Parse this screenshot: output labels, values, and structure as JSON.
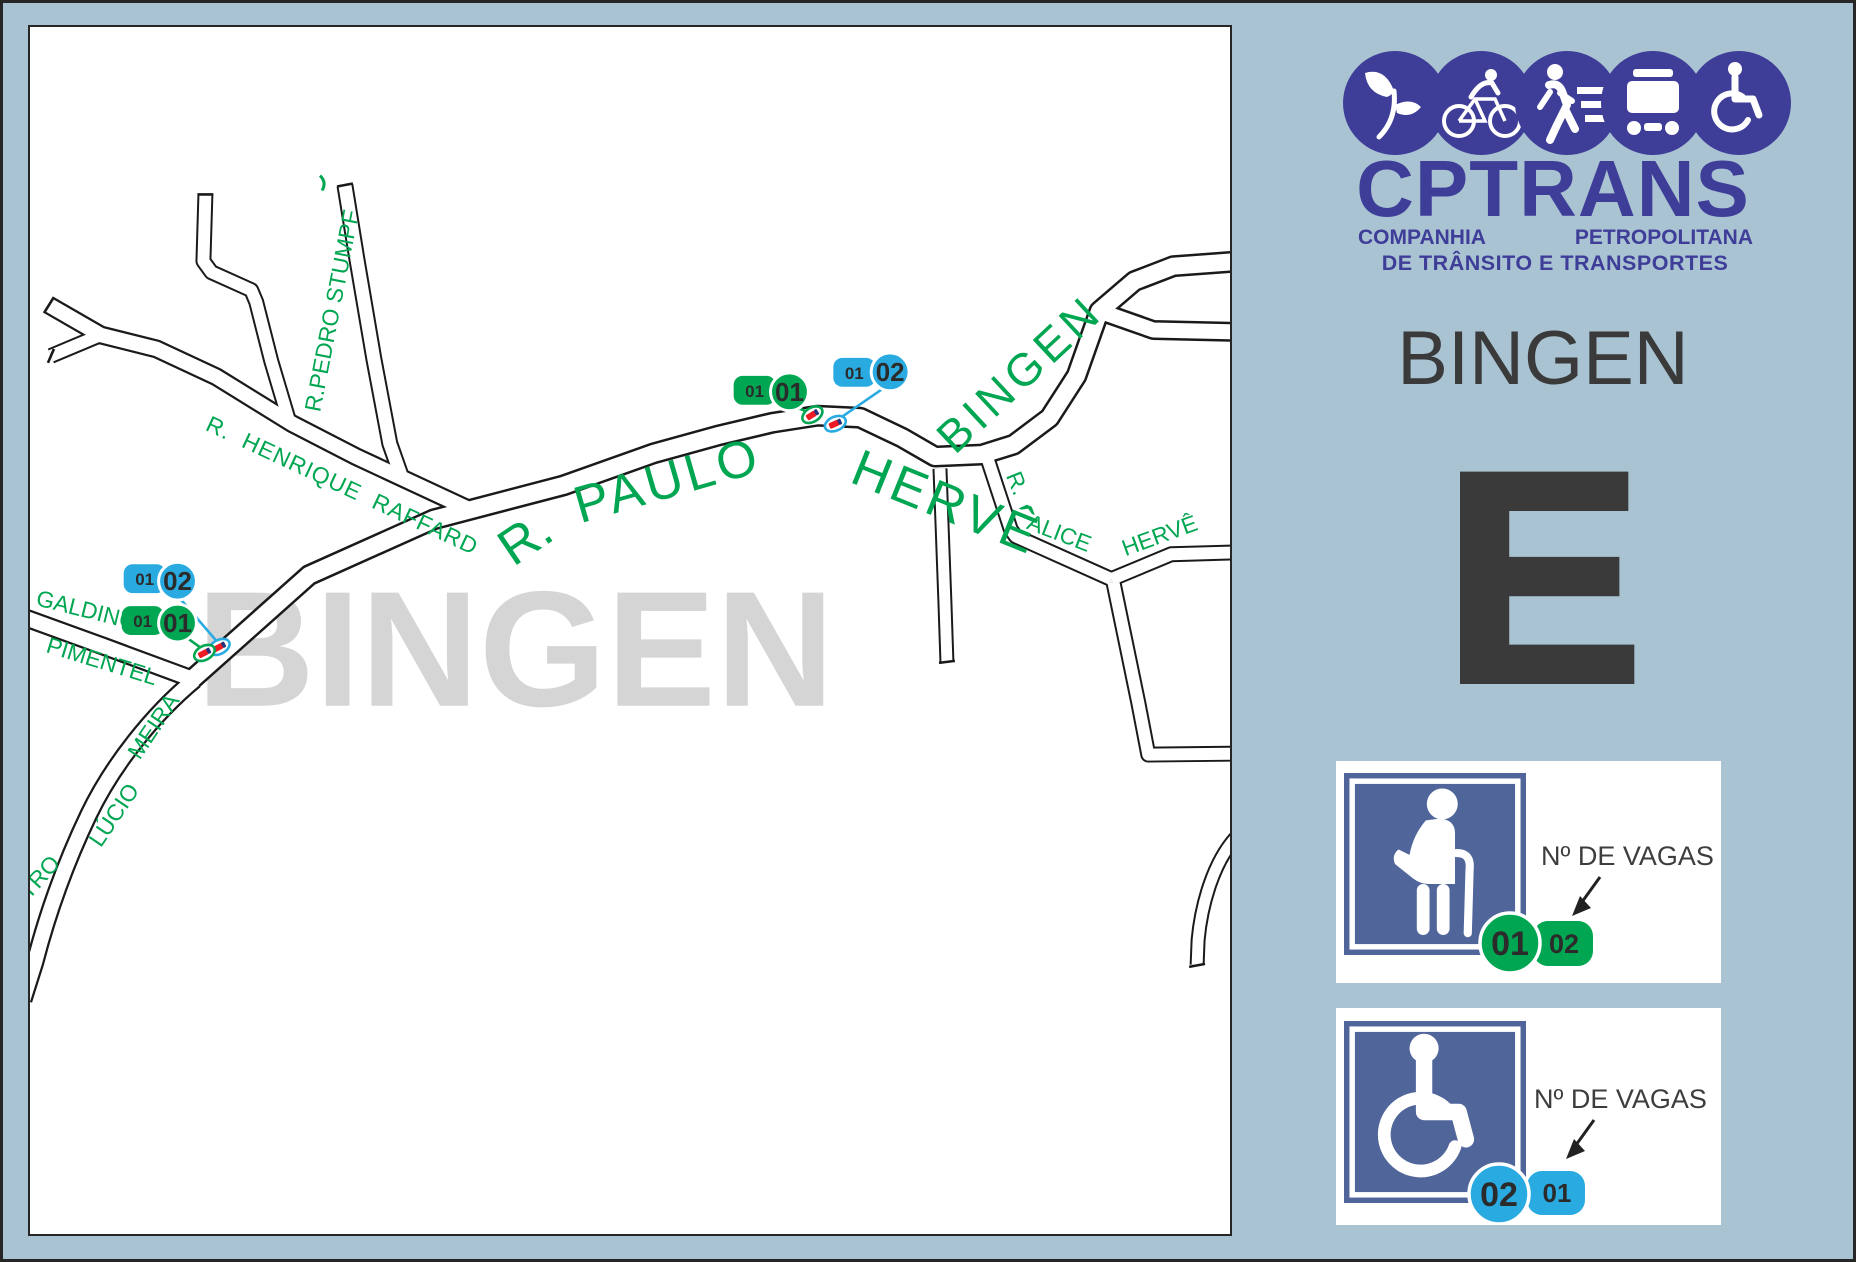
{
  "colors": {
    "background": "#a9c3d2",
    "frame": "#262626",
    "map_background": "#ffffff",
    "road_outline": "#1a1a1a",
    "street_label_green": "#00a651",
    "marker_green": "#00a651",
    "marker_blue": "#29abe2",
    "car_red": "#ed1c24",
    "watermark_gray": "#d5d5d5",
    "logo_blue": "#3e3e99",
    "heading_gray": "#3a3a3a",
    "legend_square_blue": "#50659a"
  },
  "logo": {
    "name": "CPTRANS",
    "subtitle_left": "COMPANHIA",
    "subtitle_right": "PETROPOLITANA",
    "subtitle2": "DE TRÂNSITO E TRANSPORTES",
    "icons": [
      "leaf-icon",
      "cyclist-icon",
      "pedestrian-icon",
      "bus-icon",
      "wheelchair-icon"
    ]
  },
  "sidebar": {
    "district": "BINGEN",
    "zone_letter": "E"
  },
  "legend": [
    {
      "type": "elderly",
      "label": "Nº DE VAGAS",
      "circle": "01",
      "tag": "02"
    },
    {
      "type": "wheelchair",
      "label": "Nº DE VAGAS",
      "circle": "02",
      "tag": "01"
    }
  ],
  "map": {
    "watermark": "BINGEN",
    "district_label": "BINGEN",
    "streets": {
      "pedro_stumpf": "R.PEDRO STUMPF",
      "henrique_raffard": "R.  HENRIQUE  RAFFARD",
      "paulo_prefix": "R.",
      "paulo": "PAULO",
      "herve": "HERVÊ",
      "galdino": "GALDINO",
      "pimentel": "PIMENTEL",
      "meira": "MEIRA",
      "lucio": "LÚCIO",
      "tro": "TRO",
      "alice_prefix": "R.",
      "alice": "ALICE",
      "alice_herve": "HERVÊ"
    },
    "markers": {
      "herve_green": {
        "tag": "01",
        "circle": "01"
      },
      "herve_blue": {
        "tag": "01",
        "circle": "02"
      },
      "galdino_green": {
        "tag": "01",
        "circle": "01"
      },
      "galdino_blue": {
        "tag": "01",
        "circle": "02"
      }
    }
  }
}
